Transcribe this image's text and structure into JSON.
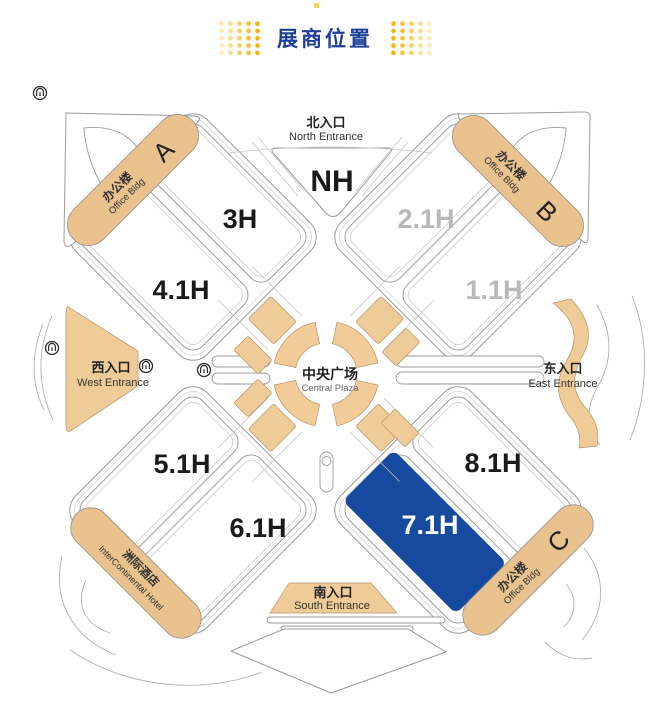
{
  "page_title": "展商位置",
  "map": {
    "halls": {
      "nh": {
        "label": "NH",
        "status": "available"
      },
      "h3": {
        "label": "3H",
        "status": "available"
      },
      "h41": {
        "label": "4.1H",
        "status": "available"
      },
      "h21": {
        "label": "2.1H",
        "status": "unavailable"
      },
      "h11": {
        "label": "1.1H",
        "status": "unavailable"
      },
      "h51": {
        "label": "5.1H",
        "status": "available"
      },
      "h61": {
        "label": "6.1H",
        "status": "available"
      },
      "h81": {
        "label": "8.1H",
        "status": "available"
      },
      "h71": {
        "label": "7.1H",
        "status": "selected"
      }
    },
    "entrances": {
      "north": {
        "zh": "北入口",
        "en": "North Entrance"
      },
      "south": {
        "zh": "南入口",
        "en": "South Entrance"
      },
      "west": {
        "zh": "西入口",
        "en": "West Entrance"
      },
      "east": {
        "zh": "东入口",
        "en": "East Entrance"
      }
    },
    "plaza": {
      "zh": "中央广场",
      "en": "Central Plaza"
    },
    "buildings": {
      "office_a": {
        "zh": "办公楼",
        "en": "Office Bldg",
        "letter": "A"
      },
      "office_b": {
        "zh": "办公楼",
        "en": "Office Bldg",
        "letter": "B"
      },
      "office_c": {
        "zh": "办公楼",
        "en": "Office Bldg",
        "letter": "C"
      },
      "hotel": {
        "zh": "洲际酒店",
        "en": "InterContinental Hotel"
      }
    },
    "colors": {
      "accent": "#1d3e99",
      "highlight": "#164a9e",
      "walkway": "#eecb97",
      "dimmed_label": "#b8b8b8",
      "dots": "#f6b40a"
    }
  }
}
